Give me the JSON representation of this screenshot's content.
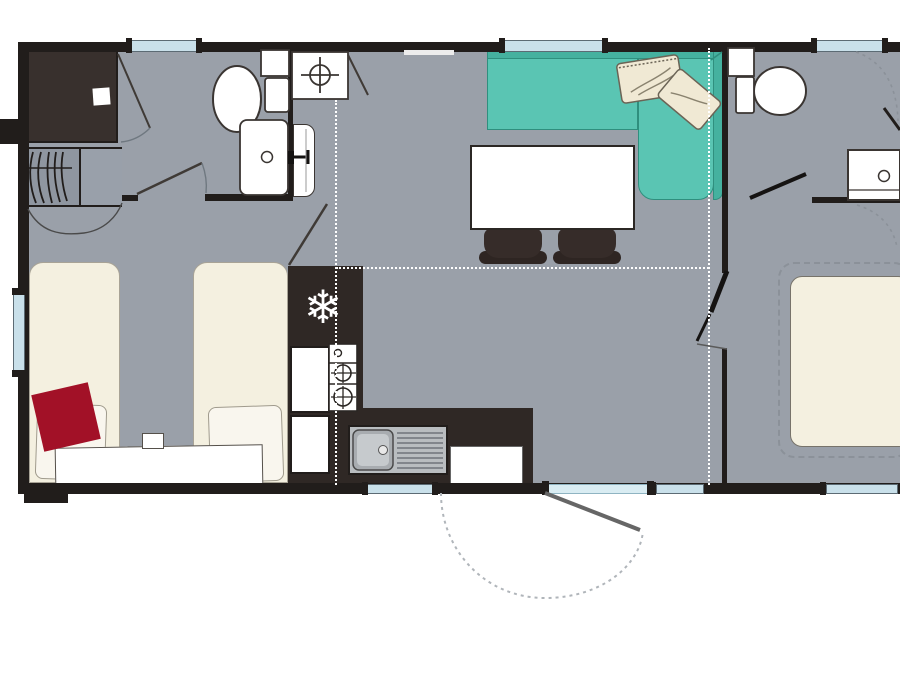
{
  "title": "mobile-home-floor-plan",
  "icons": {
    "snowflake": "❄"
  },
  "palette": {
    "wall": "#211d1b",
    "floor": "#9aa0a9",
    "kitchen": "#2f2825",
    "shower": "#38302d",
    "wardrobe": "#8f96a0",
    "sofa": "#5ac5b3",
    "sofaback": "#45b19f",
    "sofaline": "#2f8f7e",
    "mattress": "#f4f0e0",
    "pillow": "#f9f6ee",
    "red": "#a21127",
    "glass": "#c9e0ea",
    "doorglass": "#d9ecf2",
    "chair": "#362c29",
    "steel": "#b9bdc0",
    "dash": "#8b9199"
  }
}
